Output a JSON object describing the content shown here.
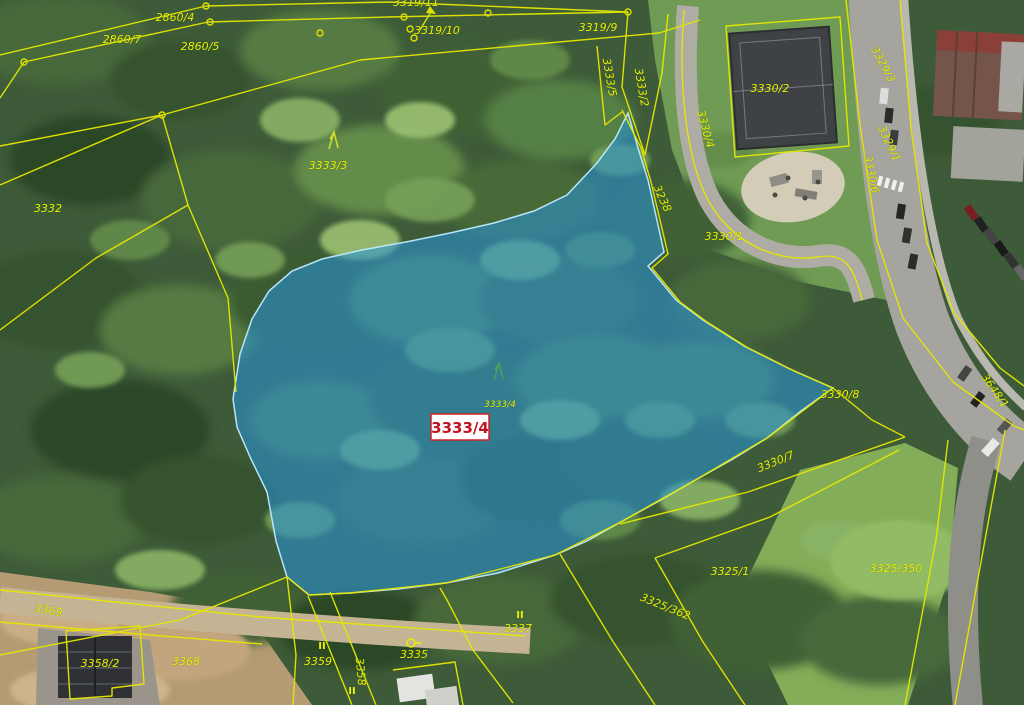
{
  "map": {
    "colors": {
      "parcel_line": "#e6e800",
      "label_text": "#e8ef00",
      "highlight_fill": "#2992d4",
      "highlight_edge": "#bfe9ff",
      "highlight_label_text": "#c01420",
      "highlight_label_bg": "#ffffff",
      "highlight_label_border": "#d02028"
    },
    "highlight": {
      "parcel": "3333/4"
    },
    "labels": [
      {
        "text": "2860/4",
        "x": 175,
        "y": 21
      },
      {
        "text": "2860/7",
        "x": 122,
        "y": 43
      },
      {
        "text": "2860/5",
        "x": 200,
        "y": 50
      },
      {
        "text": "3319/11",
        "x": 416,
        "y": 6
      },
      {
        "text": "3319/10",
        "x": 437,
        "y": 34
      },
      {
        "text": "3319/9",
        "x": 598,
        "y": 31
      },
      {
        "text": "3333/5",
        "x": 606,
        "y": 78,
        "rot": 80
      },
      {
        "text": "3333/2",
        "x": 638,
        "y": 88,
        "rot": 80
      },
      {
        "text": "3330/2",
        "x": 770,
        "y": 92
      },
      {
        "text": "3330/4",
        "x": 702,
        "y": 130,
        "rot": 75
      },
      {
        "text": "3329/3",
        "x": 880,
        "y": 66,
        "rot": 62
      },
      {
        "text": "3329/1",
        "x": 886,
        "y": 145,
        "rot": 65
      },
      {
        "text": "3330/6",
        "x": 868,
        "y": 175,
        "rot": 78
      },
      {
        "text": "3330/1",
        "x": 724,
        "y": 240
      },
      {
        "text": "3238",
        "x": 659,
        "y": 200,
        "rot": 65
      },
      {
        "text": "3332",
        "x": 48,
        "y": 212
      },
      {
        "text": "3333/3",
        "x": 328,
        "y": 169
      },
      {
        "text": "3333/4",
        "x": 500,
        "y": 407,
        "size": 9
      },
      {
        "text": "3330/8",
        "x": 840,
        "y": 398
      },
      {
        "text": "3330/7",
        "x": 777,
        "y": 465,
        "rot": -22
      },
      {
        "text": "3648/1",
        "x": 992,
        "y": 393,
        "rot": 55
      },
      {
        "text": "3325/350",
        "x": 896,
        "y": 572
      },
      {
        "text": "3325/1",
        "x": 730,
        "y": 575
      },
      {
        "text": "3325/362",
        "x": 664,
        "y": 610,
        "rot": 22
      },
      {
        "text": "3337",
        "x": 518,
        "y": 632
      },
      {
        "text": "3335",
        "x": 414,
        "y": 658
      },
      {
        "text": "3359",
        "x": 318,
        "y": 665
      },
      {
        "text": "3358",
        "x": 357,
        "y": 672,
        "rot": 85
      },
      {
        "text": "3358/2",
        "x": 100,
        "y": 667
      },
      {
        "text": "3368",
        "x": 186,
        "y": 665
      },
      {
        "text": "3369",
        "x": 48,
        "y": 614,
        "rot": 10
      }
    ],
    "symbols": [
      {
        "type": "tree",
        "x": 333,
        "y": 140,
        "color": "#cede2a"
      },
      {
        "type": "tree",
        "x": 498,
        "y": 371,
        "color": "#49a05e"
      },
      {
        "type": "roman-ii",
        "x": 520,
        "y": 618
      },
      {
        "type": "roman-ii",
        "x": 322,
        "y": 649
      },
      {
        "type": "roman-ii",
        "x": 352,
        "y": 694
      },
      {
        "type": "well",
        "x": 411,
        "y": 643
      }
    ]
  }
}
